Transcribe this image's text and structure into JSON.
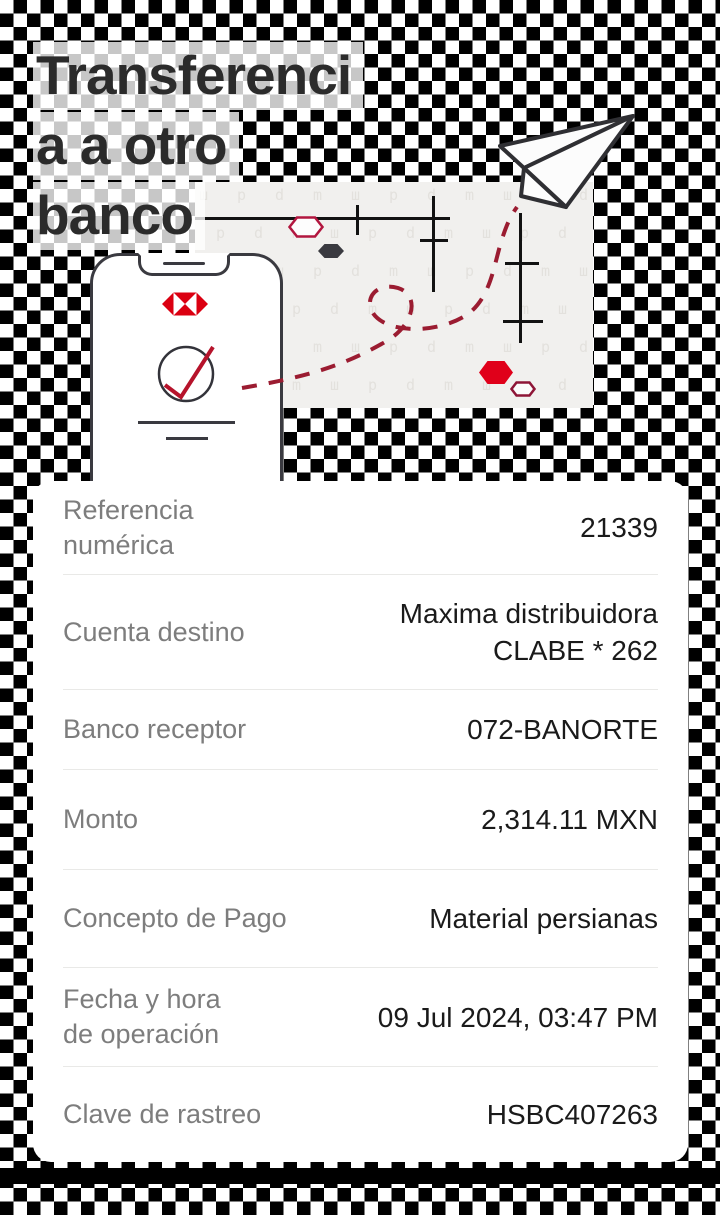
{
  "colors": {
    "brand_red": "#db0011",
    "route_red": "#9b1c31",
    "hex_red": "#e0001a",
    "checker_black": "#000000",
    "panel_gray": "#f1f0ee",
    "card_white": "#ffffff",
    "label_gray": "#7d7d7d",
    "value_ink": "#1a1a1a",
    "title_ink": "#2b2b2b"
  },
  "title": {
    "full_text": "Transferencia a otro banco",
    "lines": [
      "Transferenci",
      "a a otro",
      "banco"
    ]
  },
  "illustration": {
    "icons": [
      {
        "name": "phone-icon"
      },
      {
        "name": "hsbc-logo-icon"
      },
      {
        "name": "success-check-icon"
      },
      {
        "name": "paper-plane-icon"
      },
      {
        "name": "hexagon-red-icon"
      },
      {
        "name": "hexagon-outline-icon"
      },
      {
        "name": "hexagon-dark-icon"
      },
      {
        "name": "dashed-route"
      }
    ]
  },
  "details": {
    "rows": [
      {
        "label": "Referencia",
        "label2": "numérica",
        "value": "21339"
      },
      {
        "label": "Cuenta destino",
        "value": "Maxima distribuidora",
        "value2": "CLABE * 262"
      },
      {
        "label": "Banco receptor",
        "value": "072-BANORTE"
      },
      {
        "label": "Monto",
        "value": "2,314.11 MXN"
      },
      {
        "label": "Concepto de Pago",
        "value": "Material persianas"
      },
      {
        "label": "Fecha y hora",
        "label2": "de operación",
        "value": "09 Jul 2024, 03:47 PM"
      },
      {
        "label": "Clave de rastreo",
        "value": "HSBC407263"
      }
    ]
  }
}
